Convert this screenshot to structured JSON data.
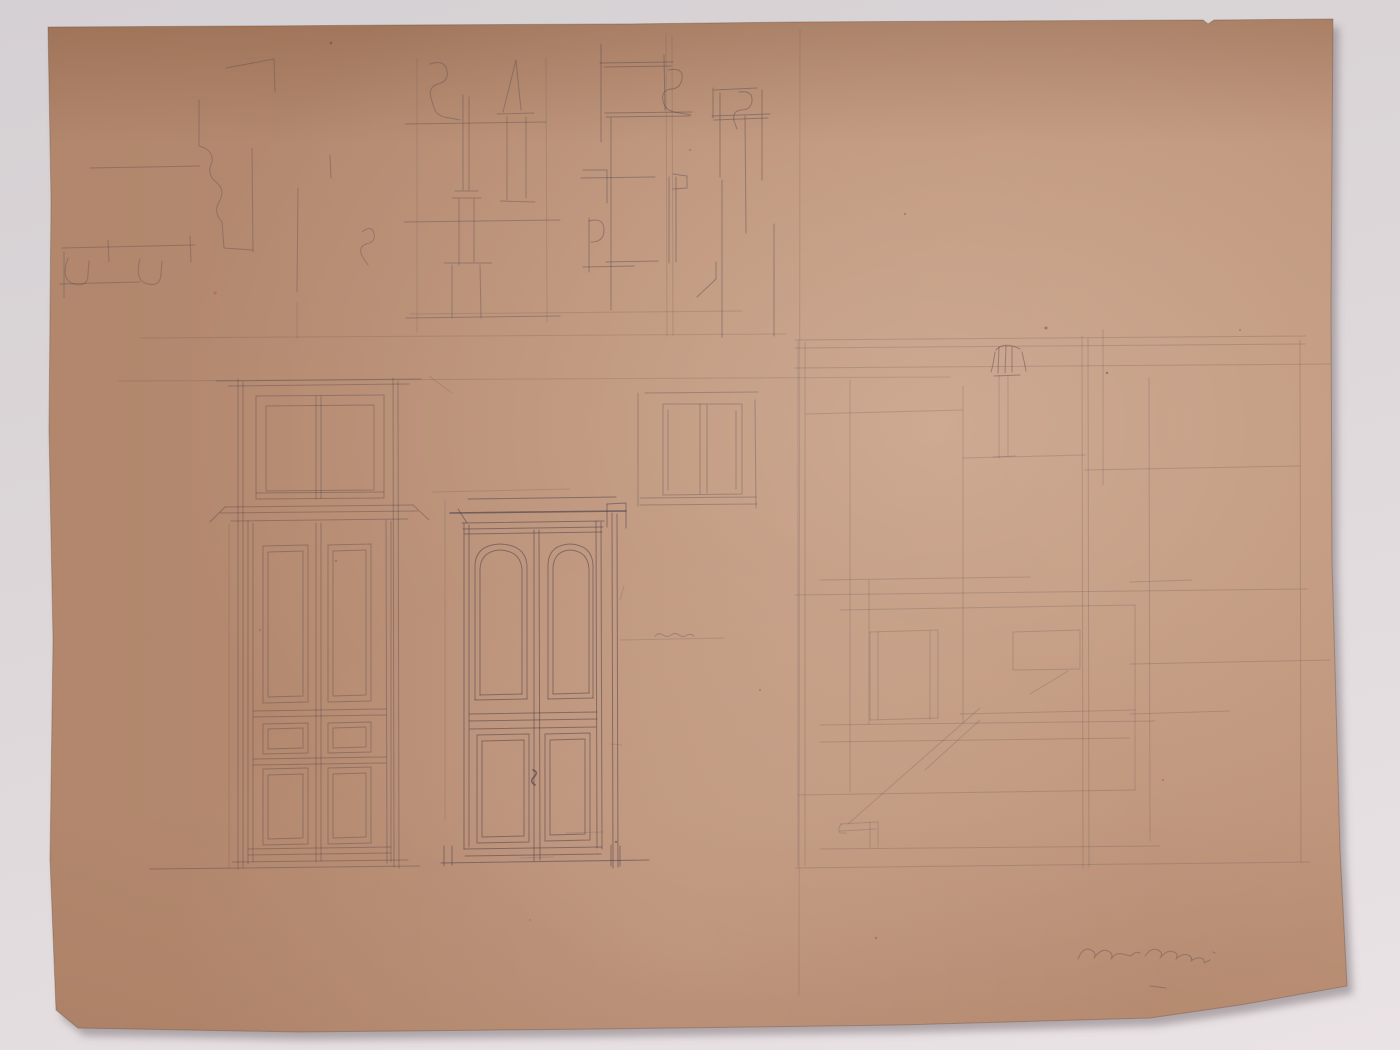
{
  "photo": {
    "background": {
      "top": "#d5d0d3",
      "mid": "#ddd7d9",
      "bottom": "#eae3e5"
    },
    "shadow_color": "rgba(108,96,103,0.45)"
  },
  "paper": {
    "outline": "48,27 250,26 400,25 620,24 798,22 1000,21 1203,20 1208,24 1214,20 1333,19 1331,300 1332,560 1340,850 1347,986 1240,1005 1150,1018 900,1025 600,1029 300,1032 78,1028 56,1010 50,860 53,640 49,430 51,200",
    "base_color": "#bc9278",
    "edge_color": "rgba(100,70,50,0.35)"
  },
  "pencil": {
    "color": "#453c4a",
    "groups": [
      {
        "name": "construction-guides",
        "opacity": 0.16,
        "width": 1,
        "paths": [
          "M140,338 L786,334",
          "M118,381 L950,377",
          "M417,58 L417,332",
          "M546,58 L547,322",
          "M666,34 L667,336",
          "M672,36 L673,335",
          "M410,314 L742,311",
          "M297,302 L297,338",
          "M429,376 L452,393",
          "M445,500 L445,820",
          "M432,492 L570,489",
          "M229,524 L229,868",
          "M800,30 L799,995",
          "M620,640 L724,638",
          "M566,833 L603,832",
          "M520,858 L553,857",
          "M610,744 L622,745",
          "M624,586 L620,600"
        ]
      },
      {
        "name": "molding-profiles-top-left",
        "opacity": 0.3,
        "width": 1,
        "paths": [
          "M62,248 L195,245",
          "M60,284 L140,282",
          "M68,258 Q60,280 74,284 Q88,288 88,274 L89,261",
          "M140,259 Q134,281 148,284 Q161,287 161,273 L162,261",
          "M108,240 L109,262",
          "M190,236 L191,262",
          "M64,252 L64,298",
          "M226,68 L274,59 L275,92",
          "M199,100 L199,146 Q214,150 212,162 Q206,174 216,182 Q226,190 219,202 Q213,212 222,222 L224,248 L253,250",
          "M252,148 L253,252",
          "M90,168 L200,166",
          "M298,188 L297,292",
          "M330,155 L331,178",
          "M362,232 Q372,224 374,234 Q376,242 366,244 Q358,247 362,256 L368,265"
        ]
      },
      {
        "name": "profiles-top-center",
        "opacity": 0.33,
        "width": 1,
        "paths": [
          "M430,64 Q445,59 447,71 Q449,81 438,84 Q428,87 431,98 L434,108 Q437,117 450,118 L460,120",
          "M463,95 L463,190",
          "M469,97 L469,190",
          "M455,191 L478,191",
          "M452,198 L481,198",
          "M459,199 L459,265",
          "M474,199 L474,262",
          "M452,265 L452,318",
          "M480,265 L481,318",
          "M444,263 L492,263",
          "M503,112 L516,60 L521,110",
          "M497,114 L534,113",
          "M507,117 L507,200",
          "M526,117 L526,198",
          "M500,201 L535,202",
          "M405,124 L546,122",
          "M404,222 L560,220",
          "M406,318 L560,316"
        ]
      },
      {
        "name": "profiles-top-right",
        "opacity": 0.38,
        "width": 1,
        "paths": [
          "M601,44 L601,142",
          "M600,63 L673,62",
          "M604,67 L671,66",
          "M664,55 L665,110",
          "M668,70 Q684,67 682,79 Q680,89 671,89 Q661,90 663,101 Q665,110 674,112 L691,115",
          "M605,113 L692,112",
          "M606,117 L690,116",
          "M611,118 L611,310",
          "M714,90 L757,88",
          "M713,88 L713,118",
          "M739,92 Q753,90 752,101 Q751,110 741,110 Q732,111 734,121 L737,129",
          "M712,116 L770,114",
          "M714,120 L768,118",
          "M720,93 L720,177",
          "M745,116 L746,233",
          "M762,90 L762,180",
          "M581,178 L655,177",
          "M583,170 L607,170 L607,203",
          "M589,218 L589,272",
          "M589,221 Q604,217 604,230 Q604,242 591,242",
          "M583,267 L634,266",
          "M669,177 L669,263",
          "M676,177 L676,262",
          "M673,174 L687,176 L687,188 L673,189",
          "M606,262 L658,261",
          "M697,297 L716,279 L716,262",
          "M722,180 L722,337",
          "M774,224 L774,336"
        ]
      },
      {
        "name": "transom-panel-study",
        "opacity": 0.3,
        "width": 1,
        "paths": [
          "M645,393 L758,392",
          "M638,393 L638,506",
          "M755,400 L756,508",
          "M640,505 L757,504",
          "M663,404 L742,404 L742,494 L663,495 Z",
          "M668,410 L668,490",
          "M736,411 L736,489",
          "M700,404 L700,494",
          "M707,405 L707,493",
          "M640,498 L756,497"
        ]
      },
      {
        "name": "double-door-study",
        "opacity": 0.34,
        "width": 1,
        "paths": [
          "M216,381 L421,379",
          "M228,386 L409,384",
          "M238,379 L238,869",
          "M243,382 L243,867",
          "M393,378 L394,867",
          "M398,381 L399,868",
          "M256,396 L384,395 L384,498 L256,499 Z",
          "M266,406 L374,405 L374,490 L266,491 Z",
          "M316,396 L316,499",
          "M321,396 L321,498",
          "M256,493 L384,492",
          "M225,507 L413,505",
          "M220,513 L418,511",
          "M231,521 L408,519",
          "M225,507 L210,522",
          "M413,505 L429,520",
          "M248,521 L248,864",
          "M253,523 L253,862",
          "M386,520 L387,863",
          "M391,521 L391,862",
          "M316,523 L316,862",
          "M321,523 L321,861",
          "M263,546 L308,545 L308,702 L263,703 Z",
          "M268,552 L303,551 L303,696 L268,697 Z",
          "M328,545 L371,544 L371,701 L328,702 Z",
          "M333,551 L366,550 L366,695 L333,696 Z",
          "M253,711 L386,709",
          "M253,717 L386,715",
          "M263,724 L308,723 L308,753 L263,754 Z",
          "M268,729 L303,728 L303,748 L268,749 Z",
          "M328,723 L371,722 L371,752 L328,753 Z",
          "M333,728 L366,727 L366,747 L333,748 Z",
          "M253,759 L386,757",
          "M253,765 L386,763",
          "M263,769 L308,768 L308,844 L263,845 Z",
          "M268,775 L303,774 L303,838 L268,839 Z",
          "M328,768 L371,767 L371,843 L328,844 Z",
          "M333,774 L366,773 L366,837 L333,838 Z",
          "M248,849 L391,847",
          "M248,855 L391,853",
          "M150,869 L420,866",
          "M232,862 L408,860"
        ]
      },
      {
        "name": "paneled-door-study",
        "opacity": 0.5,
        "width": 1,
        "paths": [
          "M468,499 L616,497",
          "M607,504 L626,503 L626,528",
          "M607,504 L607,527",
          "M458,509 L467,523",
          "M462,523 L604,521",
          "M463,529 L603,527",
          "M464,534 L602,532",
          "M464,523 L464,849",
          "M469,525 L469,847",
          "M596,521 L597,848",
          "M601,522 L602,849",
          "M612,513 L613,868",
          "M617,514 L618,867",
          "M534,530 L534,861",
          "M539,530 L540,860",
          "M475,565 Q476,545 500,544 Q526,545 527,566 L527,699 M475,565 L475,700",
          "M480,569 Q481,551 500,550 Q521,551 522,570 L522,694 M480,569 L480,695",
          "M475,700 L527,699",
          "M480,695 L522,694",
          "M548,564 Q549,545 570,544 Q592,545 593,565 L593,698 M548,564 L548,699",
          "M553,568 Q554,551 570,550 Q588,551 589,569 L589,693 M553,568 L553,694",
          "M548,699 L593,698",
          "M553,694 L589,693",
          "M469,714 L597,712",
          "M469,721 L597,719",
          "M470,729 L596,727",
          "M477,735 L529,734 L529,842 L477,843 Z",
          "M482,741 L524,740 L524,836 L482,837 Z",
          "M545,734 L590,733 L590,840 L545,841 Z",
          "M550,740 L585,739 L585,834 L550,835 Z",
          "M464,849 L602,847",
          "M465,856 L601,854",
          "M441,863 L649,860",
          "M444,846 L444,866",
          "M452,846 L452,865",
          "M611,845 L611,866",
          "M620,846 L620,866"
        ]
      },
      {
        "name": "door-cornice-bold",
        "opacity": 0.62,
        "width": 1.6,
        "paths": [
          "M450,513 L626,511",
          "M533,770 Q539,772 534,777 Q529,781 535,785"
        ]
      },
      {
        "name": "wall-elevation-study",
        "opacity": 0.19,
        "width": 1,
        "paths": [
          "M795,340 L1306,336",
          "M795,348 L1305,344",
          "M795,368 L1330,364",
          "M798,341 L798,866",
          "M805,342 L805,865",
          "M850,380 L850,792",
          "M869,580 L869,724",
          "M963,386 L963,722",
          "M999,375 L999,458",
          "M1008,376 L1008,457",
          "M993,457 L1016,456",
          "M1082,336 L1083,868",
          "M1088,338 L1089,867",
          "M1103,330 L1103,485",
          "M1149,378 L1150,841",
          "M1300,340 L1301,862",
          "M806,414 L963,410",
          "M963,458 L1085,455",
          "M1085,470 L1300,466",
          "M795,595 L1307,589",
          "M840,610 L1135,605",
          "M820,580 L1030,577",
          "M870,632 L938,630",
          "M870,632 L870,720",
          "M878,632 L878,719",
          "M930,631 L930,719",
          "M938,631 L938,718",
          "M870,720 L938,718",
          "M1013,632 L1080,630 L1080,669 L1013,670 Z",
          "M820,725 L1155,721",
          "M820,742 L1130,738",
          "M960,714 L1135,710",
          "M848,824 L980,708",
          "M925,770 L980,720",
          "M1030,694 L1068,671",
          "M840,824 L878,822",
          "M840,831 L876,829",
          "M870,822 L870,848",
          "M878,822 L878,847",
          "M842,824 Q837,828 840,833 L846,833",
          "M820,849 L1160,846",
          "M795,868 L1310,862",
          "M1130,582 L1192,580",
          "M1130,664 L1330,660",
          "M1130,714 L1230,711",
          "M798,795 L1135,790",
          "M1135,605 L1135,790"
        ]
      },
      {
        "name": "capital-detail",
        "opacity": 0.4,
        "width": 1,
        "paths": [
          "M996,350 Q1004,341 1020,349",
          "M999,347 L998,373",
          "M1006,346 L1005,373",
          "M1012,347 L1012,372",
          "M994,376 L1020,375",
          "M995,352 Q993,366 991,372",
          "M1022,352 Q1025,365 1026,371"
        ]
      },
      {
        "name": "dimension-note",
        "opacity": 0.3,
        "width": 1,
        "paths": [
          "M655,636 Q659,632 663,635 Q667,638 671,635 Q675,632 679,635 Q683,638 687,635 Q690,633 694,636"
        ]
      },
      {
        "name": "artist-signature",
        "opacity": 0.3,
        "width": 1.1,
        "paths": [
          "M1078,959 Q1083,946 1091,950 Q1097,953 1094,958 Q1101,948 1108,951 Q1114,954 1111,959 Q1116,952 1122,954 L1131,956 Q1135,951 1140,953",
          "M1145,956 Q1151,947 1158,950 Q1164,953 1160,958 Q1167,949 1174,952 Q1179,954 1176,959 Q1182,953 1188,955 Q1193,957 1191,961 Q1196,957 1201,958 Q1205,959 1204,963 L1210,960",
          "M1150,986 L1166,988",
          "M1213,952 L1215,953"
        ]
      }
    ],
    "specks": [
      {
        "x": 215,
        "y": 293,
        "r": 1.6,
        "c": "#b95f33"
      },
      {
        "x": 331,
        "y": 43,
        "r": 1.3,
        "c": "#5d4a43"
      },
      {
        "x": 1046,
        "y": 328,
        "r": 1.5,
        "c": "#6b544d"
      },
      {
        "x": 1107,
        "y": 373,
        "r": 1.2,
        "c": "#6b544d"
      },
      {
        "x": 616,
        "y": 842,
        "r": 1.2,
        "c": "#5d4a43"
      },
      {
        "x": 905,
        "y": 214,
        "r": 1.1,
        "c": "#8a6450"
      },
      {
        "x": 1240,
        "y": 330,
        "r": 1.0,
        "c": "#8a6450"
      },
      {
        "x": 760,
        "y": 690,
        "r": 1.0,
        "c": "#8a6450"
      },
      {
        "x": 336,
        "y": 561,
        "r": 1.0,
        "c": "#6b544d"
      },
      {
        "x": 876,
        "y": 938,
        "r": 1.2,
        "c": "#8a6450"
      },
      {
        "x": 530,
        "y": 920,
        "r": 1.0,
        "c": "#9a7258"
      },
      {
        "x": 1163,
        "y": 780,
        "r": 1.0,
        "c": "#8a6450"
      },
      {
        "x": 690,
        "y": 150,
        "r": 1.0,
        "c": "#8a6450"
      },
      {
        "x": 260,
        "y": 630,
        "r": 1.0,
        "c": "#8a6450"
      }
    ]
  }
}
